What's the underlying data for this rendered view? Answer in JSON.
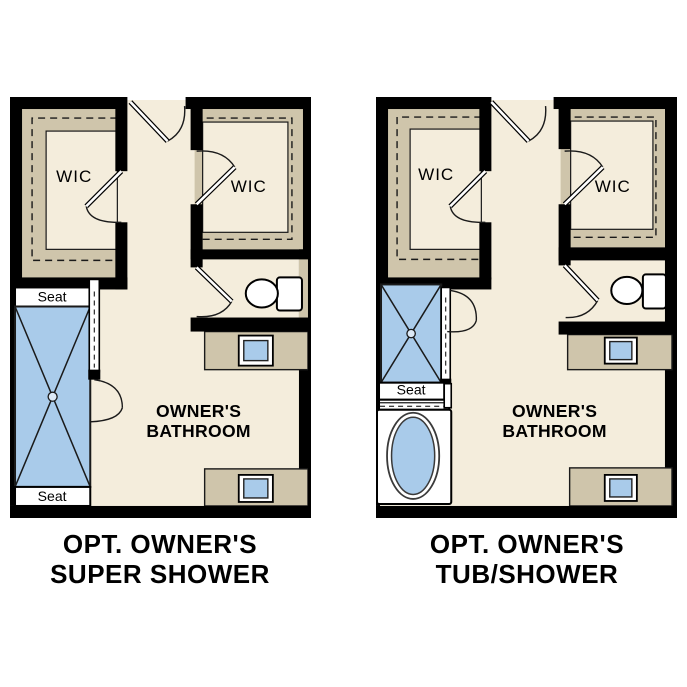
{
  "document": {
    "type": "floor-plan-options-sheet",
    "background": "#ffffff"
  },
  "colors": {
    "wall": "#000000",
    "floor": "#f4eddc",
    "closet_shelving": "#cfc5ab",
    "fixture_blue": "#a9cbea",
    "white_fixture": "#ffffff",
    "text": "#000000"
  },
  "plans": [
    {
      "id": "super-shower-option",
      "title": [
        "OPT. OWNER'S",
        "SUPER SHOWER"
      ],
      "rooms": {
        "wic_left": "WIC",
        "wic_right": "WIC",
        "bathroom": [
          "OWNER'S",
          "BATHROOM"
        ]
      },
      "shower": {
        "seat_top": "Seat",
        "seat_bottom": "Seat"
      },
      "fixtures": [
        "walk-in-super-shower-with-two-seats",
        "toilet",
        "vanity-sink-upper",
        "vanity-sink-lower"
      ]
    },
    {
      "id": "tub-shower-option",
      "title": [
        "OPT. OWNER'S",
        "TUB/SHOWER"
      ],
      "rooms": {
        "wic_left": "WIC",
        "wic_right": "WIC",
        "bathroom": [
          "OWNER'S",
          "BATHROOM"
        ]
      },
      "shower": {
        "seat": "Seat"
      },
      "fixtures": [
        "shower-with-seat",
        "soaking-tub",
        "toilet",
        "vanity-sink-upper",
        "vanity-sink-lower"
      ]
    }
  ]
}
